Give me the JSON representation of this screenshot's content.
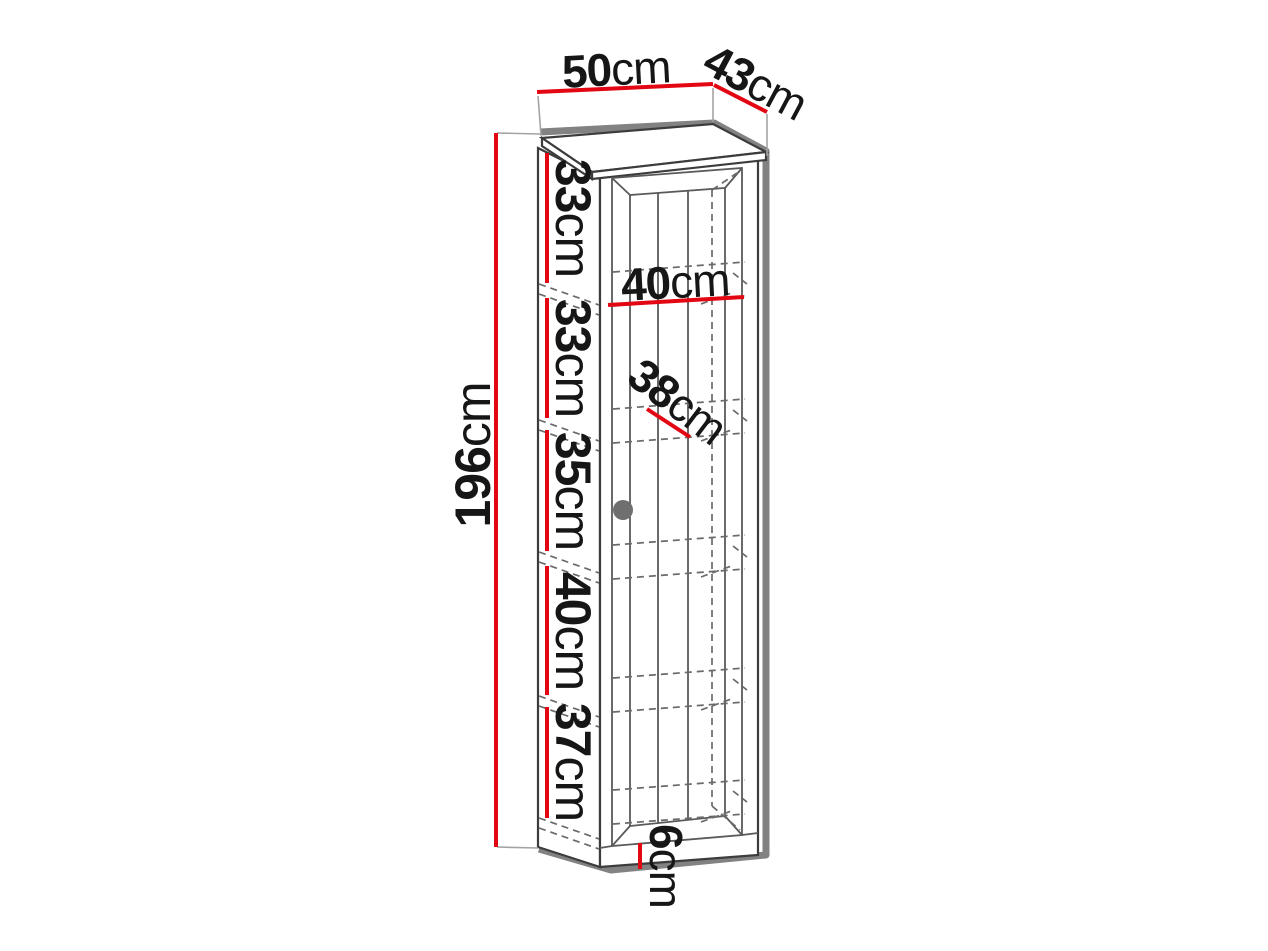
{
  "dims": {
    "top_width": {
      "value": "50",
      "unit": "cm"
    },
    "top_depth": {
      "value": "43",
      "unit": "cm"
    },
    "total_height": {
      "value": "196",
      "unit": "cm"
    },
    "section_1_height": {
      "value": "33",
      "unit": "cm"
    },
    "section_2_height": {
      "value": "33",
      "unit": "cm"
    },
    "section_3_height": {
      "value": "35",
      "unit": "cm"
    },
    "section_4_height": {
      "value": "40",
      "unit": "cm"
    },
    "section_5_height": {
      "value": "37",
      "unit": "cm"
    },
    "interior_width": {
      "value": "40",
      "unit": "cm"
    },
    "interior_depth": {
      "value": "38",
      "unit": "cm"
    },
    "base_height": {
      "value": "6",
      "unit": "cm"
    }
  },
  "colors": {
    "dimension_red": "#e30613",
    "shadow_gray": "#828282",
    "outline_dark": "#3c3c3c",
    "detail_gray": "#5a5a5a",
    "hidden_line_gray": "#6a6a6a",
    "extension_gray": "#a3a3a3",
    "knob_gray": "#6f6f6f",
    "background": "#ffffff"
  }
}
